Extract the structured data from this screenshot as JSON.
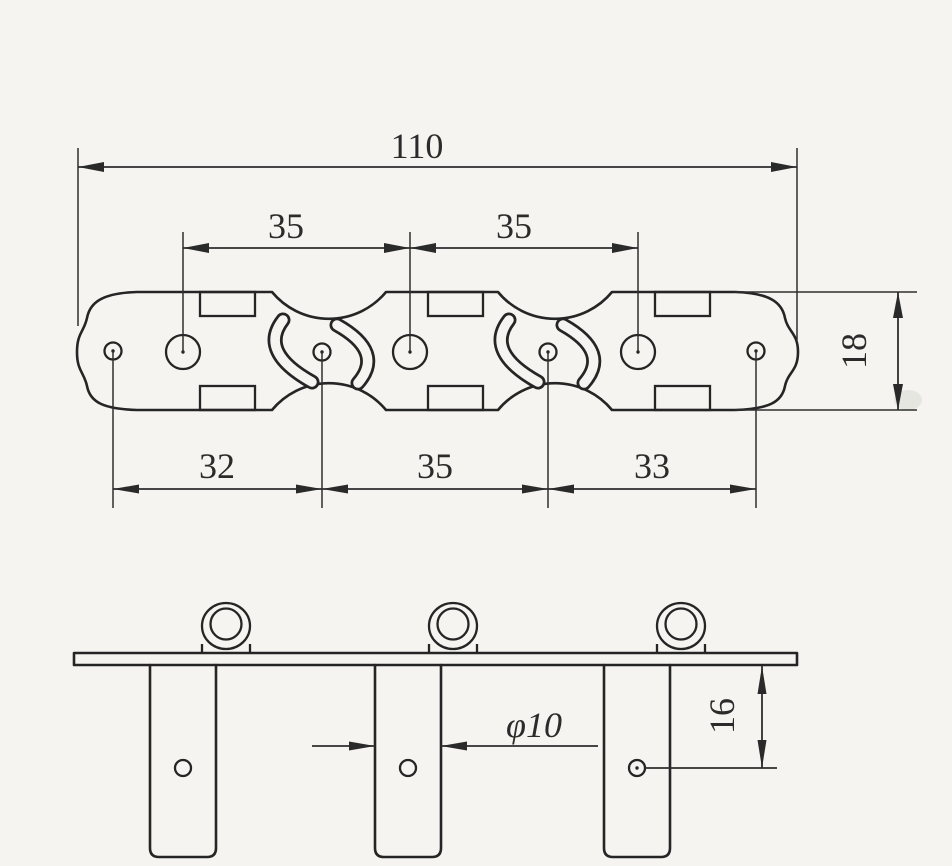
{
  "drawing": {
    "type": "technical-drawing",
    "subject": "guitar tuning machine base plate, top view and side view",
    "background_color": "#f5f4f1",
    "line_color": "#252525",
    "top_view": {
      "overall_width": "110",
      "post_spacing_1": "35",
      "post_spacing_2": "35",
      "plate_height": "18",
      "hole_spacing_1": "32",
      "hole_spacing_2": "35",
      "hole_spacing_3": "33"
    },
    "side_view": {
      "post_diameter": "φ10",
      "hole_distance": "16"
    }
  }
}
